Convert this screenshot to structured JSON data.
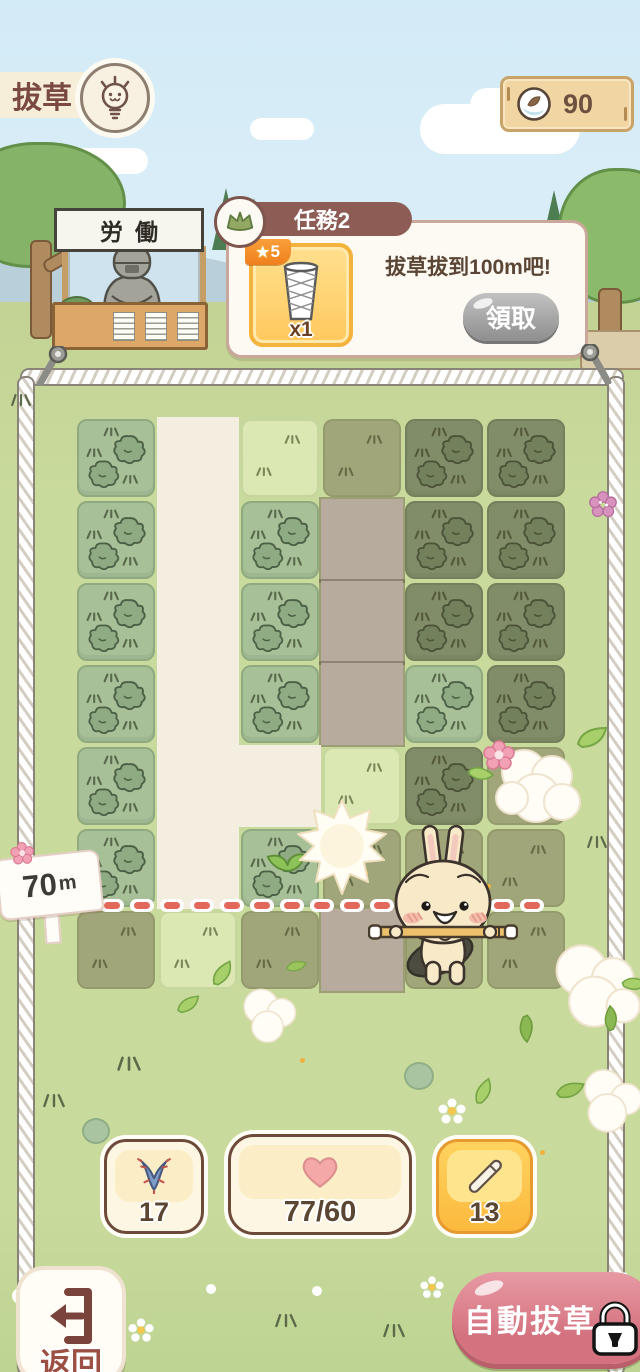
{
  "header": {
    "title": "拔草",
    "currency": {
      "value": "90",
      "icon": "seed-icon"
    },
    "hint_icon": "lightbulb-icon"
  },
  "quest": {
    "title": "任務2",
    "description": "拔草拔到100m吧!",
    "claim_label": "領取",
    "reward": {
      "star_icon": "★",
      "stars": "5",
      "count": "x1",
      "icon": "trash-basket-icon"
    }
  },
  "booth": {
    "sign": "労働"
  },
  "field": {
    "distance_label_value": "70",
    "distance_label_unit": "m",
    "grid": [
      [
        "grass",
        "path",
        "empty",
        "empty:d",
        "grass:d",
        "grass:d"
      ],
      [
        "grass",
        "path",
        "grass",
        "path:d",
        "grass:d",
        "grass:d"
      ],
      [
        "grass",
        "path",
        "grass",
        "path:d",
        "grass:d",
        "grass:d"
      ],
      [
        "grass",
        "path",
        "grass",
        "path:d",
        "grass",
        "grass:d"
      ],
      [
        "grass",
        "path",
        "path",
        "empty",
        "grass:d",
        "empty:d"
      ],
      [
        "grass",
        "path",
        "sprout",
        "empty:d",
        "empty:d",
        "empty:d"
      ],
      [
        "empty:d",
        "empty",
        "empty:d",
        "path:d",
        "empty:d",
        "empty:d"
      ]
    ]
  },
  "counters": {
    "roots": {
      "value": "17",
      "icon": "root-icon"
    },
    "hearts": {
      "value": "77/60",
      "icon": "heart-icon"
    },
    "pencils": {
      "value": "13",
      "icon": "pencil-icon"
    }
  },
  "footer": {
    "back_label": "返回",
    "auto_label": "自動拔草",
    "lock_icon": "lock-icon"
  },
  "colors": {
    "accent_pink": "#d4727f",
    "tile_green": "#a7c098",
    "tile_light": "#dbe8b4",
    "path_cream": "#f4eee1",
    "dash_red": "#e2685c",
    "quest_header": "#8d5c55"
  }
}
